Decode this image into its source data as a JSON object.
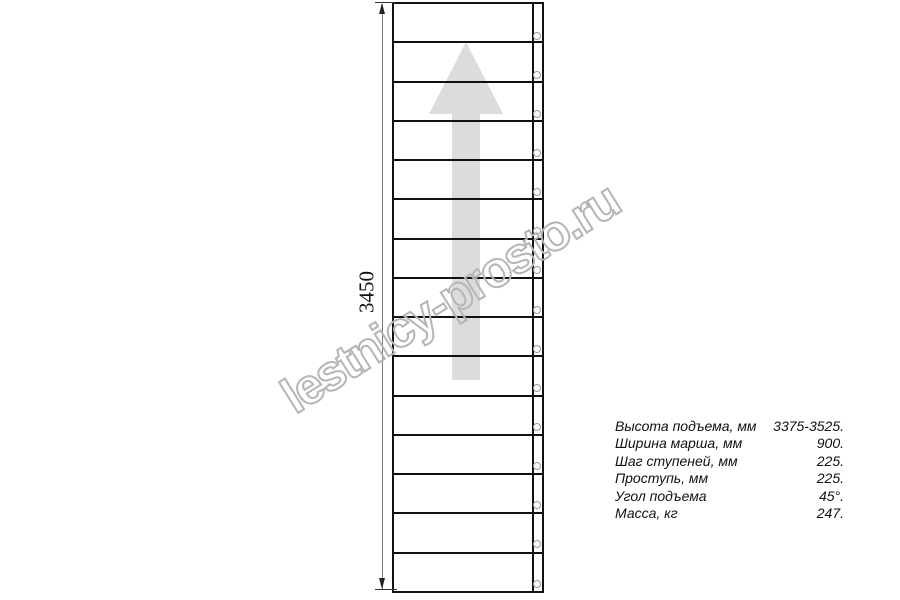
{
  "watermark": {
    "text": "lestnicy-prosto.ru",
    "outline_color": "#b5b5b5"
  },
  "drawing": {
    "dimension_label": "3450",
    "line_color": "#111111",
    "arrow": {
      "direction": "up",
      "color": "#dcdcdc"
    },
    "stairs": {
      "steps": 15,
      "fasteners": 15
    }
  },
  "specs": {
    "rows": [
      {
        "label": "Высота подъема, мм",
        "value": "3375-3525."
      },
      {
        "label": "Ширина марша, мм",
        "value": "900."
      },
      {
        "label": "Шаг ступеней, мм",
        "value": "225."
      },
      {
        "label": "Проступь, мм",
        "value": "225."
      },
      {
        "label": "Угол подъема",
        "value": "45°."
      },
      {
        "label": "Масса, кг",
        "value": "247."
      }
    ]
  }
}
